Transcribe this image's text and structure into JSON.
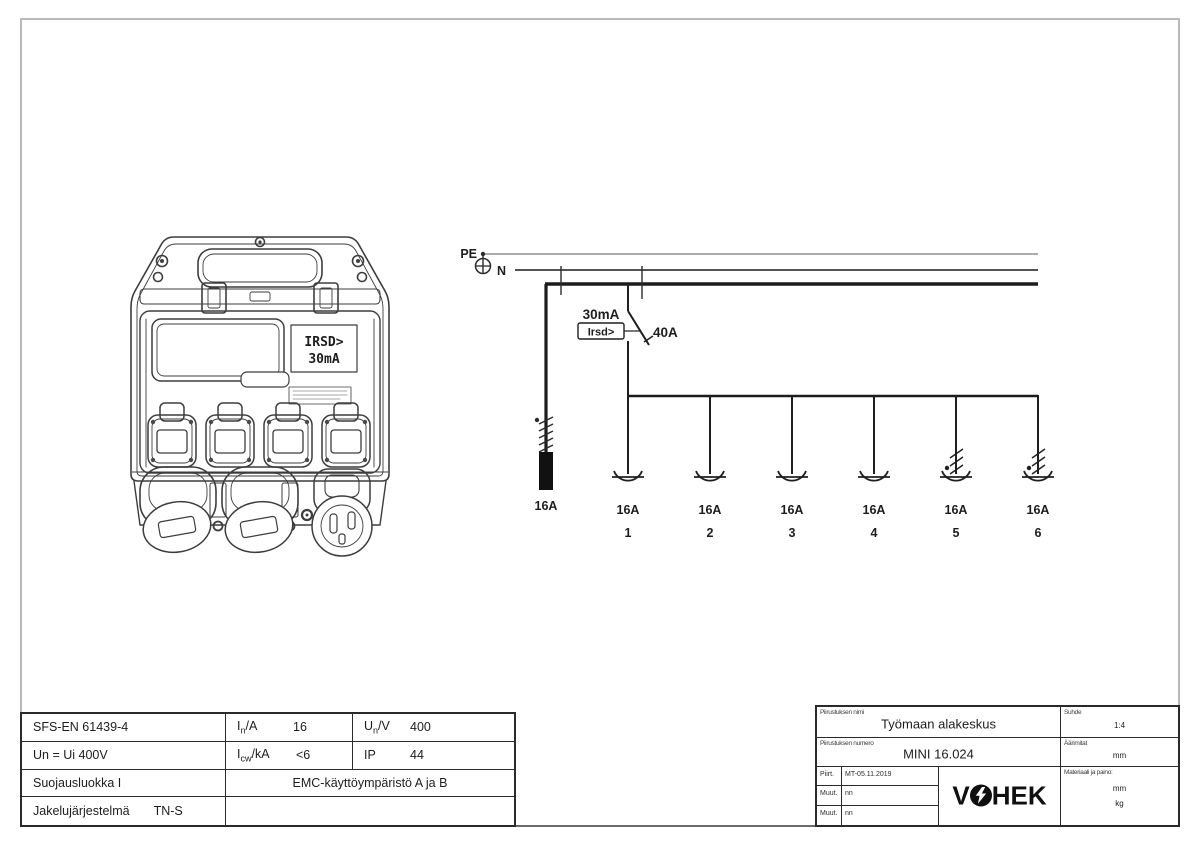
{
  "device": {
    "display_line1": "IRSD>",
    "display_line2": "30mA"
  },
  "schematic": {
    "pe_label": "PE",
    "n_label": "N",
    "rcd": {
      "sensitivity": "30mA",
      "function_label": "Irsd>",
      "rating": "40A"
    },
    "inlet": {
      "rating": "16A"
    },
    "branches": [
      {
        "rating": "16A",
        "number": "1",
        "three_phase": false
      },
      {
        "rating": "16A",
        "number": "2",
        "three_phase": false
      },
      {
        "rating": "16A",
        "number": "3",
        "three_phase": false
      },
      {
        "rating": "16A",
        "number": "4",
        "three_phase": false
      },
      {
        "rating": "16A",
        "number": "5",
        "three_phase": true
      },
      {
        "rating": "16A",
        "number": "6",
        "three_phase": true
      }
    ]
  },
  "spec_table": {
    "row1": {
      "standard": "SFS-EN 61439-4",
      "in": {
        "sym": "I",
        "sub": "n",
        "unit": "/A",
        "value": "16"
      },
      "un": {
        "sym": "U",
        "sub": "n",
        "unit": "/V",
        "value": "400"
      }
    },
    "row2": {
      "insulation": "Un = Ui 400V",
      "icw": {
        "sym": "I",
        "sub": "cw",
        "unit": "/kA",
        "value": "<6"
      },
      "ip": {
        "label": "IP",
        "value": "44"
      }
    },
    "row3": {
      "protection_class": "Suojausluokka I",
      "emc": "EMC-käyttöympäristö A ja B"
    },
    "row4": {
      "system_label": "Jakelujärjestelmä",
      "system_value": "TN-S"
    }
  },
  "title_block": {
    "name_label": "Piirustuksen nimi",
    "name": "Työmaan alakeskus",
    "number_label": "Piirustuksen numero",
    "number": "MINI 16.024",
    "scale_label": "Suhde",
    "scale": "1:4",
    "dims_label": "Äärimitat",
    "dims_value": "mm",
    "material_label": "Materiaali ja paino:",
    "material_value": "mm",
    "weight_value": "kg",
    "drawn_label": "Piirt.",
    "drawn_value": "MT-05.11.2019",
    "rev1_label": "Muut.",
    "rev1_value": "nn",
    "rev2_label": "Muut.",
    "rev2_value": "nn",
    "logo_left": "V",
    "logo_right": "HEK"
  }
}
